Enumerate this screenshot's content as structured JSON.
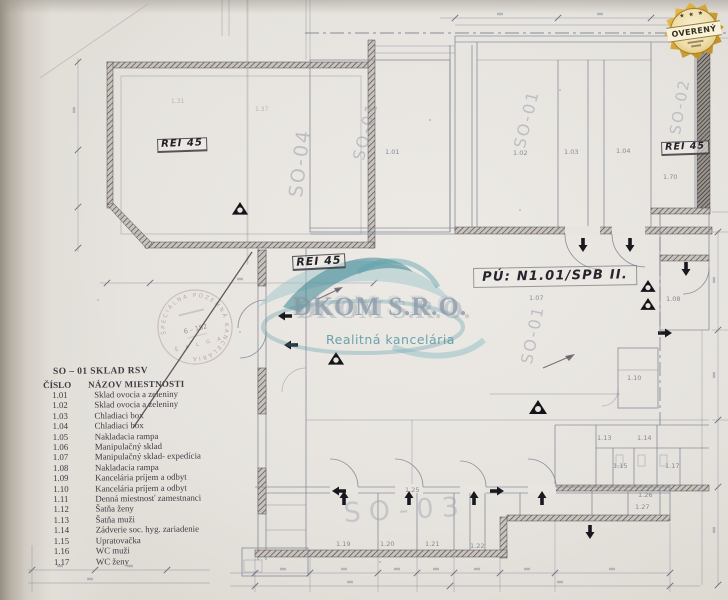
{
  "badge": {
    "label": "OVERENÝ",
    "stars": "★ ★ ★"
  },
  "watermark": {
    "title": "DKOM S.R.O.",
    "subtitle": "Realitná kancelária"
  },
  "stamp": {
    "arc_text": "ŠPECIÁLNA POZEMNÁ KANCELÁRIA",
    "num": "6 – 182",
    "bottom": "Š A L G A"
  },
  "legend": {
    "title": "SO – 01 SKLAD  RSV",
    "col_num": "ČÍSLO",
    "col_name": "NÁZOV MIESTNOSTI",
    "items": [
      {
        "num": "1.01",
        "name": "Sklad ovocia a zeleniny"
      },
      {
        "num": "1.02",
        "name": "Sklad ovocia a zeleniny"
      },
      {
        "num": "1.03",
        "name": "Chladiaci box"
      },
      {
        "num": "1.04",
        "name": "Chladiaci box"
      },
      {
        "num": "1.05",
        "name": "Nakladacia rampa"
      },
      {
        "num": "1.06",
        "name": "Manipulačný sklad"
      },
      {
        "num": "1.07",
        "name": "Manipulačný sklad- expedícia"
      },
      {
        "num": "1.08",
        "name": "Nakladacia rampa"
      },
      {
        "num": "1.09",
        "name": "Kancelária príjem a odbyt"
      },
      {
        "num": "1.10",
        "name": "Kancelária príjem a odbyt"
      },
      {
        "num": "1.11",
        "name": "Denná miestnosť zamestnanci"
      },
      {
        "num": "1.12",
        "name": "Šatňa ženy"
      },
      {
        "num": "1.13",
        "name": "Šatňa muži"
      },
      {
        "num": "1.14",
        "name": "Zádverie soc. hyg. zariadenie"
      },
      {
        "num": "1.15",
        "name": "Upratovačka"
      },
      {
        "num": "1.16",
        "name": "WC muži"
      },
      {
        "num": "1.17",
        "name": "WC ženy"
      }
    ]
  },
  "plan": {
    "labels": [
      {
        "name": "area-label-so04",
        "text": "SO-04",
        "x": 287,
        "y": 196,
        "rot": -83,
        "fs": 19,
        "cls": "area"
      },
      {
        "name": "area-label-so01-left",
        "text": "SO-01",
        "x": 351,
        "y": 158,
        "rot": -76,
        "fs": 16,
        "cls": "area"
      },
      {
        "name": "area-label-so01-mid",
        "text": "SO-01",
        "x": 512,
        "y": 146,
        "rot": -76,
        "fs": 16,
        "cls": "area"
      },
      {
        "name": "area-label-so02",
        "text": "SO-02",
        "x": 668,
        "y": 133,
        "rot": -80,
        "fs": 15,
        "cls": "area"
      },
      {
        "name": "area-label-so01-hall",
        "text": "SO-01",
        "x": 519,
        "y": 362,
        "rot": -78,
        "fs": 16,
        "cls": "area"
      },
      {
        "name": "area-label-so03",
        "text": "SO-03",
        "x": 343,
        "y": 500,
        "rot": -3,
        "fs": 27,
        "cls": "area big"
      },
      {
        "name": "rei45-label-left",
        "text": "REI 45",
        "x": 157,
        "y": 139,
        "rot": -2,
        "fs": 10,
        "cls": "rei"
      },
      {
        "name": "rei45-label-mid",
        "text": "REI 45",
        "x": 292,
        "y": 256,
        "rot": -3,
        "fs": 11,
        "cls": "rei"
      },
      {
        "name": "rei45-label-right",
        "text": "REI 45",
        "x": 661,
        "y": 142,
        "rot": -2,
        "fs": 9.5,
        "cls": "rei"
      },
      {
        "name": "pu-area-label",
        "text": "PÚ: N1.01/SPB II.",
        "x": 473,
        "y": 268,
        "rot": -1,
        "fs": 13,
        "cls": "pu"
      },
      {
        "name": "room-label-101",
        "text": "1.01",
        "x": 385,
        "y": 149,
        "rot": 0,
        "fs": 6.5,
        "cls": "room"
      },
      {
        "name": "room-label-102",
        "text": "1.02",
        "x": 513,
        "y": 150,
        "rot": 0,
        "fs": 6.5,
        "cls": "room"
      },
      {
        "name": "room-label-103",
        "text": "1.03",
        "x": 564,
        "y": 149,
        "rot": 0,
        "fs": 6.5,
        "cls": "room"
      },
      {
        "name": "room-label-104",
        "text": "1.04",
        "x": 616,
        "y": 148,
        "rot": 0,
        "fs": 6.5,
        "cls": "room"
      },
      {
        "name": "room-label-170",
        "text": "1.70",
        "x": 663,
        "y": 174,
        "rot": 0,
        "fs": 6.5,
        "cls": "room"
      },
      {
        "name": "room-label-107",
        "text": "1.07",
        "x": 529,
        "y": 295,
        "rot": 0,
        "fs": 6.5,
        "cls": "room"
      },
      {
        "name": "room-label-108",
        "text": "1.08",
        "x": 666,
        "y": 296,
        "rot": 0,
        "fs": 6.5,
        "cls": "room"
      },
      {
        "name": "room-label-110",
        "text": "1.10",
        "x": 627,
        "y": 375,
        "rot": 0,
        "fs": 6.5,
        "cls": "room"
      },
      {
        "name": "room-label-113",
        "text": "1.13",
        "x": 597,
        "y": 435,
        "rot": 0,
        "fs": 6.5,
        "cls": "room"
      },
      {
        "name": "room-label-114",
        "text": "1.14",
        "x": 637,
        "y": 435,
        "rot": 0,
        "fs": 6.5,
        "cls": "room"
      },
      {
        "name": "room-label-115",
        "text": "1.15",
        "x": 613,
        "y": 463,
        "rot": 0,
        "fs": 6.5,
        "cls": "room"
      },
      {
        "name": "room-label-117",
        "text": "1.17",
        "x": 665,
        "y": 463,
        "rot": 0,
        "fs": 6.5,
        "cls": "room"
      },
      {
        "name": "room-label-126",
        "text": "1.26",
        "x": 638,
        "y": 492,
        "rot": 0,
        "fs": 6.5,
        "cls": "room"
      },
      {
        "name": "room-label-127",
        "text": "1.27",
        "x": 635,
        "y": 504,
        "rot": 0,
        "fs": 6.5,
        "cls": "room"
      },
      {
        "name": "room-label-125",
        "text": "1.25",
        "x": 405,
        "y": 487,
        "rot": 0,
        "fs": 6.5,
        "cls": "room"
      },
      {
        "name": "room-label-119",
        "text": "1.19",
        "x": 336,
        "y": 541,
        "rot": 0,
        "fs": 6.5,
        "cls": "room"
      },
      {
        "name": "room-label-120",
        "text": "1.20",
        "x": 380,
        "y": 541,
        "rot": 0,
        "fs": 6.5,
        "cls": "room"
      },
      {
        "name": "room-label-121",
        "text": "1.21",
        "x": 425,
        "y": 541,
        "rot": 0,
        "fs": 6.5,
        "cls": "room"
      },
      {
        "name": "room-label-122",
        "text": "1.22",
        "x": 470,
        "y": 543,
        "rot": 0,
        "fs": 6.5,
        "cls": "room"
      },
      {
        "name": "room-label-131",
        "text": "1.31",
        "x": 171,
        "y": 99,
        "rot": 0,
        "fs": 6,
        "cls": "room faint"
      },
      {
        "name": "room-label-137",
        "text": "1.37",
        "x": 255,
        "y": 107,
        "rot": 0,
        "fs": 6,
        "cls": "room faint"
      }
    ]
  }
}
